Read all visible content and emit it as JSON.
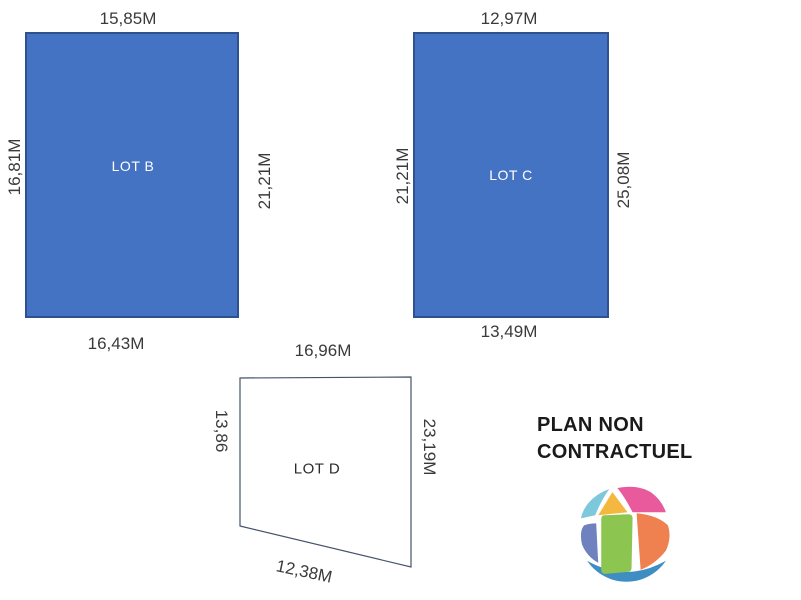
{
  "diagram": {
    "lots": [
      {
        "id": "b",
        "label": "LOT B",
        "dim_top": "15,85M",
        "dim_left": "16,81M",
        "dim_right": "21,21M",
        "dim_bottom": "16,43M",
        "fill": "#4573C4",
        "border": "#2E528F",
        "label_color": "#FFFFFF"
      },
      {
        "id": "c",
        "label": "LOT C",
        "dim_top": "12,97M",
        "dim_left": "21,21M",
        "dim_right": "25,08M",
        "dim_bottom": "13,49M",
        "fill": "#4573C4",
        "border": "#2E528F",
        "label_color": "#FFFFFF"
      },
      {
        "id": "d",
        "label": "LOT D",
        "dim_top": "16,96M",
        "dim_left": "13,86",
        "dim_right": "23,19M",
        "dim_bottom": "12,38M",
        "fill": "#FFFFFF",
        "border": "#44546A",
        "label_color": "#2B2B2B"
      }
    ],
    "disclaimer": {
      "line1": "PLAN NON",
      "line2": "CONTRACTUEL"
    },
    "logo": {
      "name": "globe-segments-logo",
      "colors": {
        "top_left": "#7EC8DC",
        "top_center": "#F4B73F",
        "top_right": "#E85A9C",
        "left": "#7081C0",
        "center": "#8DC551",
        "right": "#EF8150",
        "bottom": "#3E8EC4"
      }
    }
  }
}
